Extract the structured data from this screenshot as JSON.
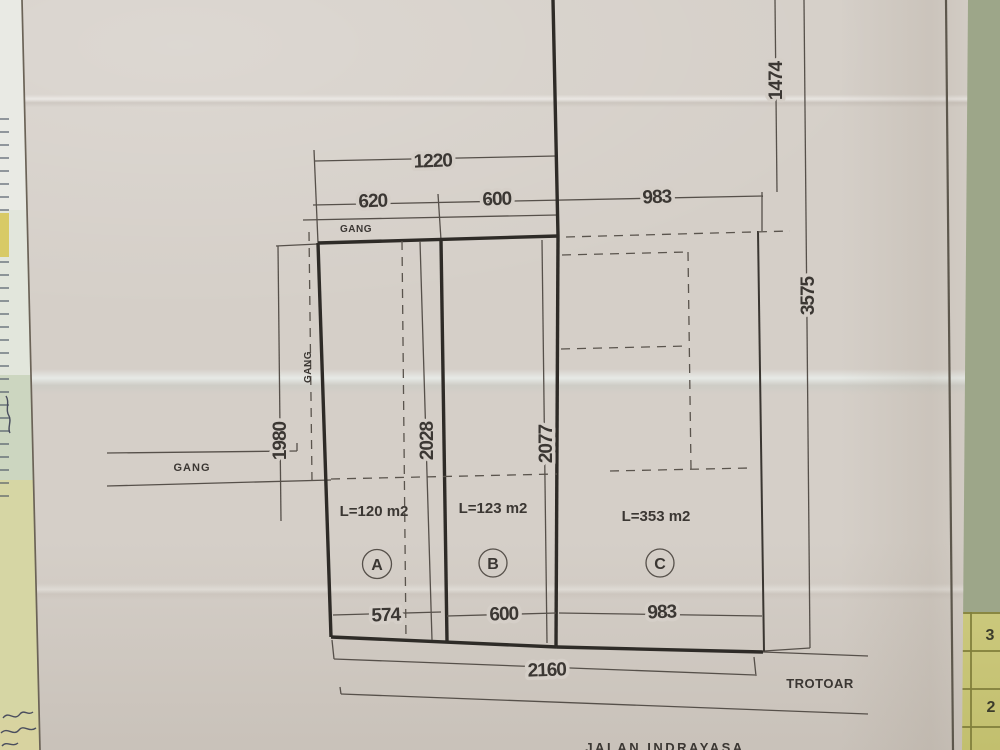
{
  "plan": {
    "dimensions": {
      "top_total": "1220",
      "top_a": "620",
      "top_b": "600",
      "top_c": "983",
      "right_upper": "1474",
      "right_full": "3575",
      "left_side": "1980",
      "depth_a": "2028",
      "depth_b": "2077",
      "bottom_a": "574",
      "bottom_b": "600",
      "bottom_c": "983",
      "bottom_total": "2160"
    },
    "plots": [
      {
        "id": "A",
        "area": "L=120 m2"
      },
      {
        "id": "B",
        "area": "L=123 m2"
      },
      {
        "id": "C",
        "area": "L=353 m2"
      }
    ],
    "labels": {
      "gang_top": "GANG",
      "gang_left": "GANG",
      "gang_side": "GANG",
      "sidewalk": "TROTOAR",
      "street": "JALAN INDRAYASA"
    }
  },
  "background": {
    "grid_digit_1": "3",
    "grid_digit_2": "2"
  },
  "colors": {
    "paper": "#d5cfc8",
    "ink_thin": "#56504a",
    "ink_thick": "#2e2b27",
    "table_green": "#9da689",
    "grid_yellow": "#cbc87c"
  }
}
